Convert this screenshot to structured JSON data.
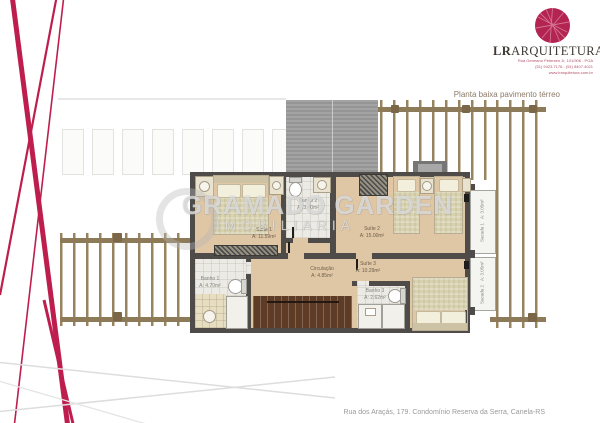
{
  "branding": {
    "firm_bold": "LR",
    "firm_rest": "ARQUITETURA",
    "contact_line1": "Rua Germano Petersen Jr, 101/906 - POA",
    "contact_line2": "(51) 9423.7176 - (51) 8407.4021",
    "contact_line3": "www.lrarquitetura.com.br"
  },
  "plan": {
    "title": "Planta baixa pavimento térreo",
    "rooms": [
      {
        "name": "Suíte 1",
        "area": "A: 11.59m²"
      },
      {
        "name": "Banho 2",
        "area": "A: 3.40m²"
      },
      {
        "name": "Suíte 2",
        "area": "A: 15.00m²"
      },
      {
        "name": "Suíte 3",
        "area": "A: 10.29m²"
      },
      {
        "name": "Banho 1",
        "area": "A: 4.70m²"
      },
      {
        "name": "Banho 3",
        "area": "A: 2.62m²"
      },
      {
        "name": "Circulação",
        "area": "A: 4.85m²"
      },
      {
        "name": "Sacada 1",
        "area": "A: 3.05m²"
      },
      {
        "name": "Sacada 2",
        "area": "A: 3.05m²"
      }
    ]
  },
  "watermark": {
    "brand": "GRAMADO GARDEN",
    "subtitle": "IMOBILIARIA"
  },
  "footer": {
    "address": "Rua dos Araçás, 179. Condomínio Reserva da Serra, Canela-RS"
  },
  "colors": {
    "accent": "#b42453",
    "wall": "#4e4b48",
    "floor": "#dfc6a4",
    "wood": "#8d7a58",
    "roof": "#9c9c9c"
  }
}
